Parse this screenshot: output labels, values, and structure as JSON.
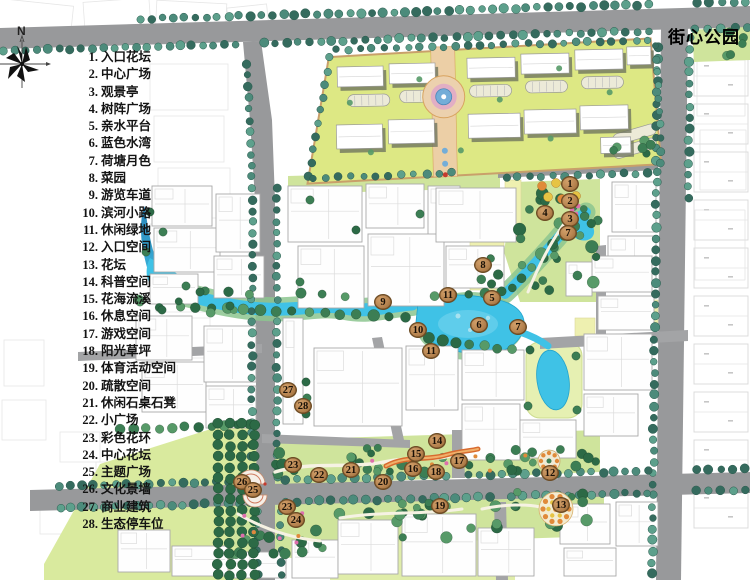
{
  "title": "街心公园",
  "north_label": "N",
  "legend": {
    "items": [
      {
        "num": "1",
        "label": "入口花坛"
      },
      {
        "num": "2",
        "label": "中心广场"
      },
      {
        "num": "3",
        "label": "观景亭"
      },
      {
        "num": "4",
        "label": "树阵广场"
      },
      {
        "num": "5",
        "label": "亲水平台"
      },
      {
        "num": "6",
        "label": "蓝色水湾"
      },
      {
        "num": "7",
        "label": "荷塘月色"
      },
      {
        "num": "8",
        "label": "菜园"
      },
      {
        "num": "9",
        "label": "游览车道"
      },
      {
        "num": "10",
        "label": "滨河小路"
      },
      {
        "num": "11",
        "label": "休闲绿地"
      },
      {
        "num": "12",
        "label": "入口空间"
      },
      {
        "num": "13",
        "label": "花坛"
      },
      {
        "num": "14",
        "label": "科普空间"
      },
      {
        "num": "15",
        "label": "花海流溪"
      },
      {
        "num": "16",
        "label": "休息空间"
      },
      {
        "num": "17",
        "label": "游戏空间"
      },
      {
        "num": "18",
        "label": "阳光草坪"
      },
      {
        "num": "19",
        "label": "体育活动空间"
      },
      {
        "num": "20",
        "label": "疏散空间"
      },
      {
        "num": "21",
        "label": "休闲石桌石凳"
      },
      {
        "num": "22",
        "label": "小广场"
      },
      {
        "num": "23",
        "label": "彩色花环"
      },
      {
        "num": "24",
        "label": "中心花坛"
      },
      {
        "num": "25",
        "label": "主题广场"
      },
      {
        "num": "26",
        "label": "文化景墙"
      },
      {
        "num": "27",
        "label": "商业建筑"
      },
      {
        "num": "28",
        "label": "生态停车位"
      }
    ]
  },
  "map": {
    "markers": [
      {
        "n": "1",
        "x": 570,
        "y": 184
      },
      {
        "n": "2",
        "x": 570,
        "y": 201
      },
      {
        "n": "3",
        "x": 570,
        "y": 219
      },
      {
        "n": "4",
        "x": 545,
        "y": 213
      },
      {
        "n": "7",
        "x": 568,
        "y": 233
      },
      {
        "n": "8",
        "x": 483,
        "y": 265
      },
      {
        "n": "11",
        "x": 448,
        "y": 295
      },
      {
        "n": "5",
        "x": 492,
        "y": 298
      },
      {
        "n": "9",
        "x": 383,
        "y": 302
      },
      {
        "n": "6",
        "x": 479,
        "y": 325
      },
      {
        "n": "7",
        "x": 518,
        "y": 327
      },
      {
        "n": "10",
        "x": 418,
        "y": 330
      },
      {
        "n": "11",
        "x": 431,
        "y": 351
      },
      {
        "n": "27",
        "x": 288,
        "y": 390
      },
      {
        "n": "28",
        "x": 303,
        "y": 406
      },
      {
        "n": "14",
        "x": 437,
        "y": 441
      },
      {
        "n": "15",
        "x": 416,
        "y": 454
      },
      {
        "n": "17",
        "x": 459,
        "y": 461
      },
      {
        "n": "16",
        "x": 413,
        "y": 469
      },
      {
        "n": "18",
        "x": 436,
        "y": 472
      },
      {
        "n": "12",
        "x": 550,
        "y": 473
      },
      {
        "n": "23",
        "x": 293,
        "y": 465
      },
      {
        "n": "22",
        "x": 319,
        "y": 475
      },
      {
        "n": "21",
        "x": 351,
        "y": 470
      },
      {
        "n": "20",
        "x": 383,
        "y": 482
      },
      {
        "n": "26",
        "x": 242,
        "y": 482
      },
      {
        "n": "25",
        "x": 253,
        "y": 490
      },
      {
        "n": "23",
        "x": 287,
        "y": 507
      },
      {
        "n": "24",
        "x": 296,
        "y": 520
      },
      {
        "n": "19",
        "x": 440,
        "y": 506
      },
      {
        "n": "13",
        "x": 561,
        "y": 505
      }
    ],
    "colors": {
      "water": "#3fc2e6",
      "water_deep": "#2b86b9",
      "water_edge": "#22a3cc",
      "bank_green": "#8cc68f",
      "road": "#98999b",
      "road_minor": "#a3a4a6",
      "lawn": "#d9ea9e",
      "lawn_bright": "#dde884",
      "park_green": "#cfe49c",
      "parcel_yellow": "#eef0b0",
      "lawn_pale": "#e0edaa",
      "tree_dark": "#2c6a46",
      "tree_mid": "#3c7e54",
      "tree_light": "#579a68",
      "street_tree": "#4c8b7b",
      "street_tree_dark": "#356b5e",
      "building": "#fefefe",
      "building_outline": "#a9a9a9",
      "building_inner": "#dcdcdc",
      "shadow": "#70755f",
      "cadastral": "#d9d9d9",
      "axis_tan": "#eccfa6",
      "path_cream": "#f6f2e3",
      "plaza_pink": "#e2aec4",
      "plaza_blue": "#74add8",
      "flower_orange": "#e08a3a",
      "flower_yellow": "#e6c343",
      "flower_pink": "#dd6fad",
      "accent_red": "#c43b2f",
      "marker_fill": "#b78450",
      "marker_edge": "#6b4a22",
      "marker_text": "#191007"
    }
  }
}
